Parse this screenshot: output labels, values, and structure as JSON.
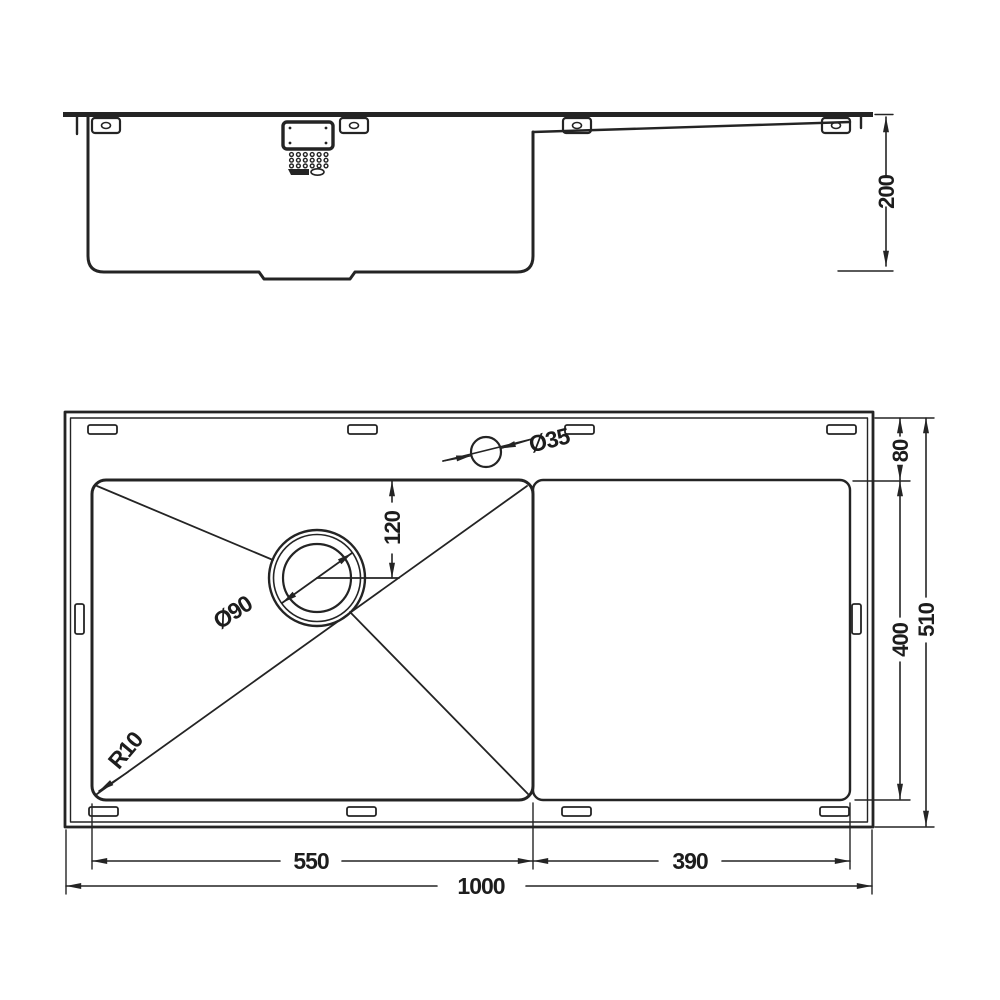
{
  "drawing": {
    "background_color": "#ffffff",
    "line_color": "#242424",
    "side_view": {
      "dim_depth": "200"
    },
    "plan_view": {
      "dim_rim_front": "80",
      "dim_bowl_width": "400",
      "dim_overall_width": "510",
      "dim_drain_center_offset": "120",
      "dim_bowl_length": "550",
      "dim_drainer_length": "390",
      "dim_overall_length": "1000",
      "tap_hole_diameter": "Ø35",
      "waste_hole_diameter": "Ø90",
      "corner_radius": "R10"
    }
  }
}
